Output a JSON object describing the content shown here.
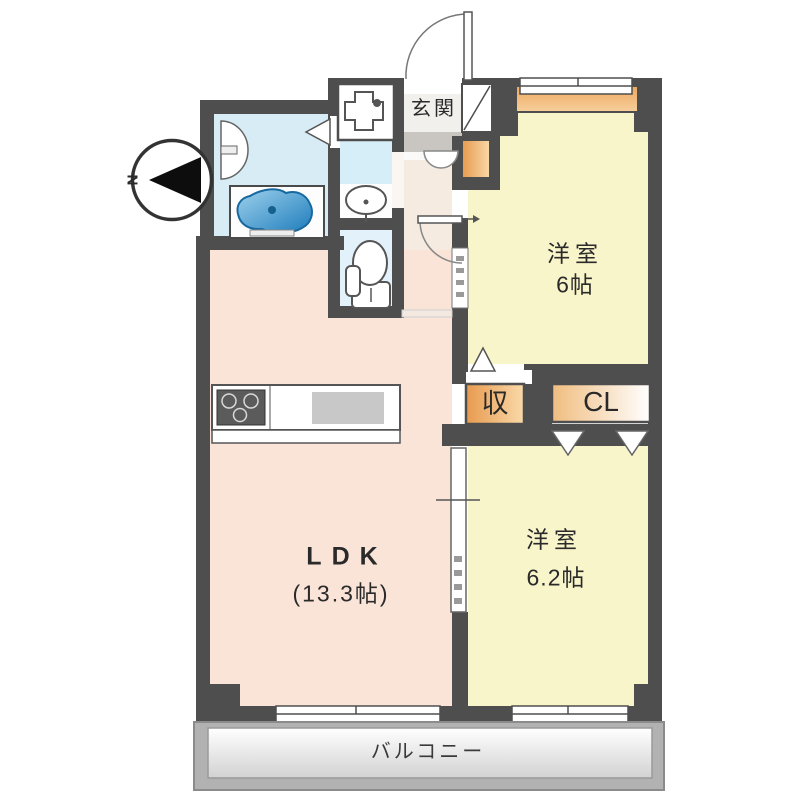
{
  "floorplan": {
    "compass": {
      "label": "N"
    },
    "entrance": {
      "label": "玄関"
    },
    "bedroom1": {
      "type": "洋室",
      "size": "6帖"
    },
    "bedroom2": {
      "type": "洋室",
      "size": "6.2帖"
    },
    "ldk": {
      "label": "LDK",
      "size": "(13.3帖)"
    },
    "storage": {
      "label": "収"
    },
    "closet": {
      "label": "CL"
    },
    "balcony": {
      "label": "バルコニー"
    },
    "colors": {
      "wall": "#4e4e4e",
      "bedroom_floor": "#f9f5ca",
      "ldk_floor": "#fae4d8",
      "hall_floor": "#f5ebe1",
      "bathroom_floor": "#d7ecf4",
      "toilet_floor": "#e3f1fa",
      "storage_orange": "#eda45b",
      "bathtub_blue": "#2b85c2",
      "balcony_gray": "#b2b2b2"
    }
  }
}
